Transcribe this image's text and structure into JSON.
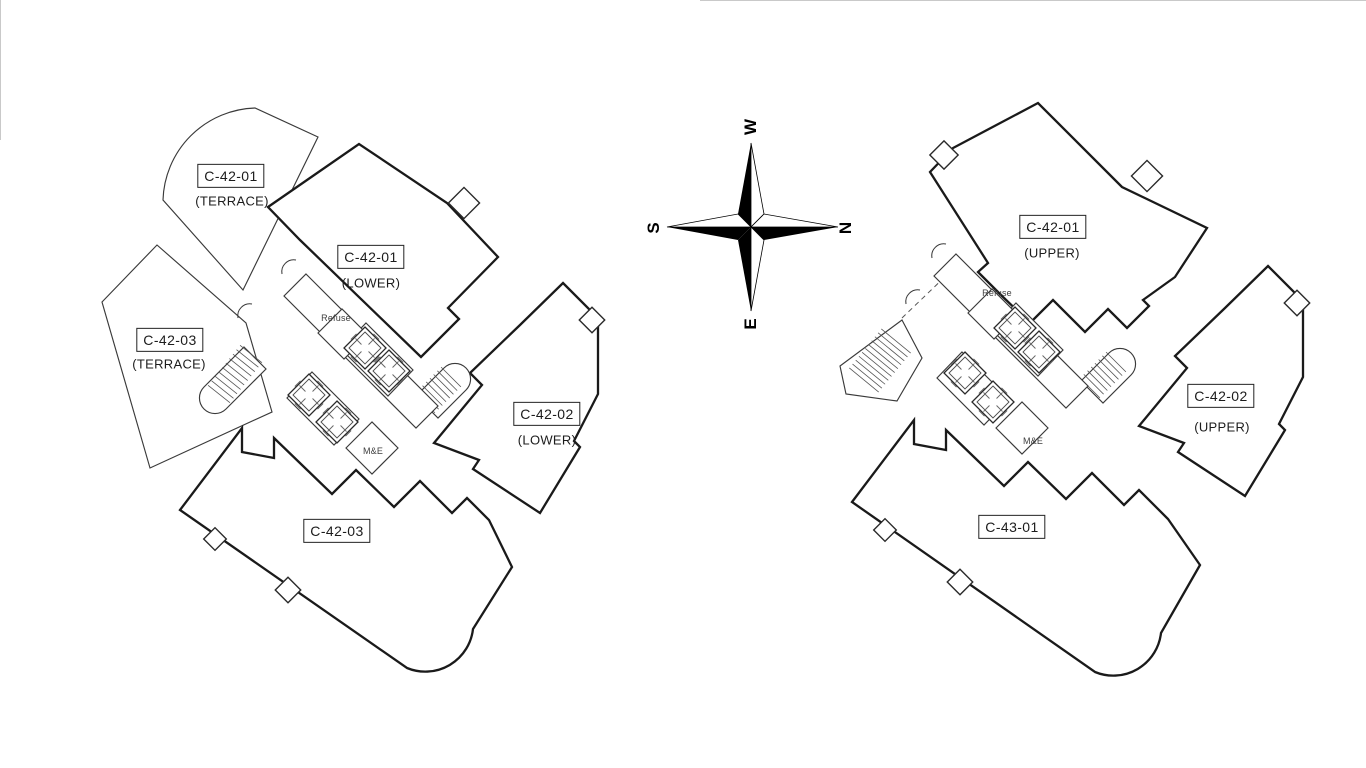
{
  "page": {
    "background": "#ffffff",
    "line_color": "#1a1a1a"
  },
  "compass": {
    "west": "W",
    "north": "N",
    "east": "E",
    "south": "S"
  },
  "plans": {
    "left": {
      "units": [
        {
          "label": "C-42-01",
          "sublabel": "(TERRACE)"
        },
        {
          "label": "C-42-01",
          "sublabel": "(LOWER)"
        },
        {
          "label": "C-42-03",
          "sublabel": "(TERRACE)"
        },
        {
          "label": "C-42-02",
          "sublabel": "(LOWER)"
        },
        {
          "label": "C-42-03",
          "sublabel": ""
        }
      ],
      "rooms": {
        "refuse": "Refuse",
        "mech": "M&E"
      }
    },
    "right": {
      "units": [
        {
          "label": "C-42-01",
          "sublabel": "(UPPER)"
        },
        {
          "label": "C-42-02",
          "sublabel": "(UPPER)"
        },
        {
          "label": "C-43-01",
          "sublabel": ""
        }
      ],
      "rooms": {
        "refuse": "Refuse",
        "mech": "M&E"
      }
    }
  }
}
